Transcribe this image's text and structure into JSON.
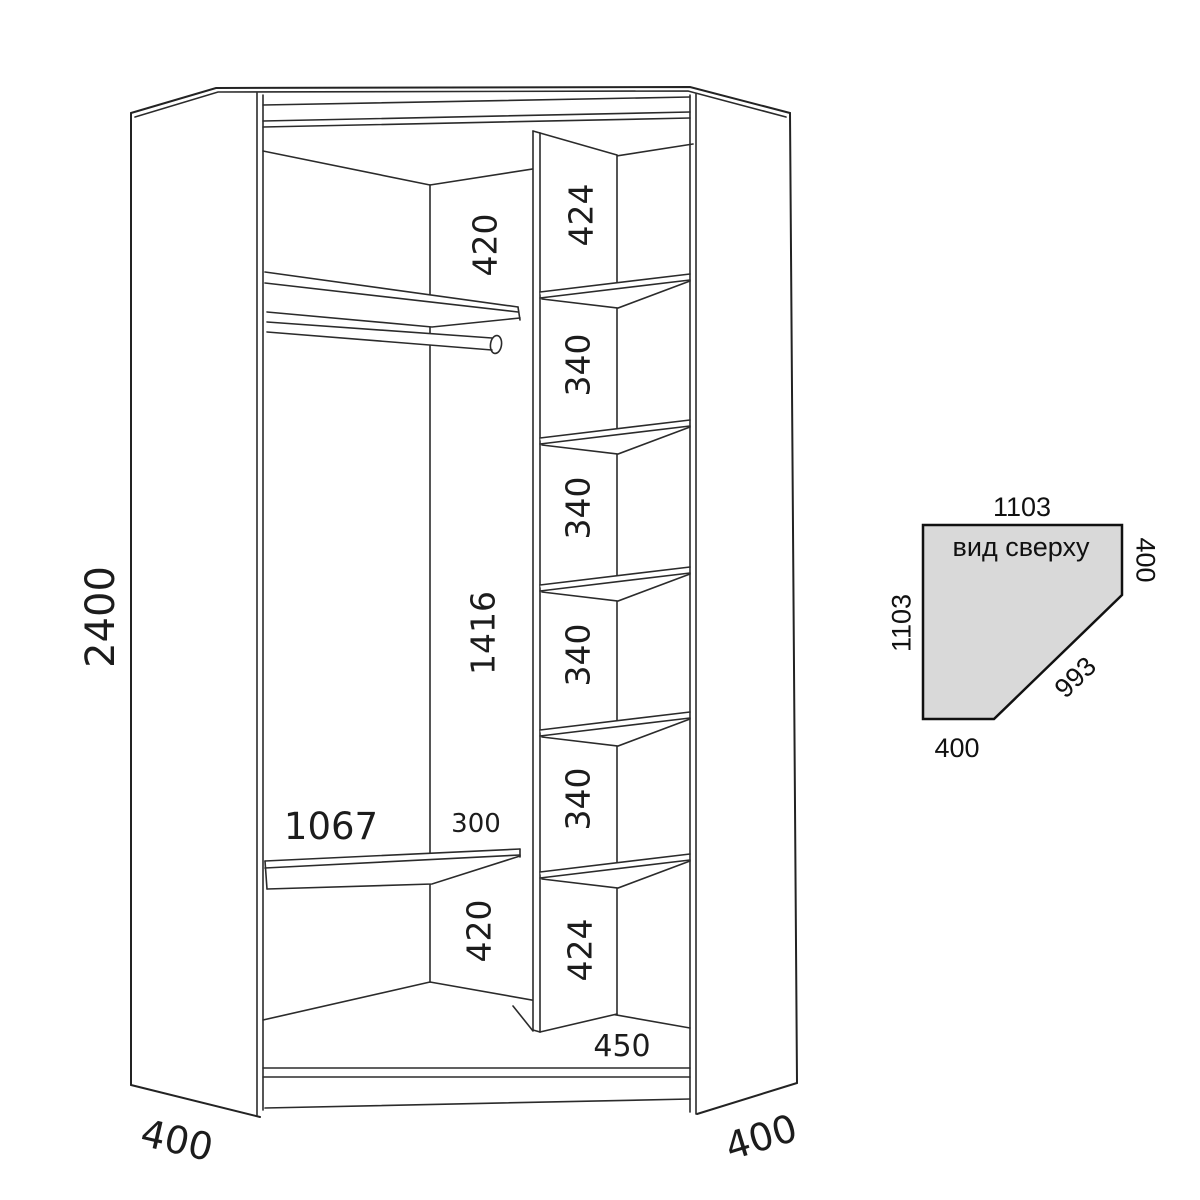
{
  "front_view": {
    "total_height": "2400",
    "left_column": {
      "top_space": "420",
      "hanging_space": "1416",
      "bottom_space": "420"
    },
    "shelf_board": {
      "width": "1067",
      "depth": "300"
    },
    "right_column": [
      "424",
      "340",
      "340",
      "340",
      "340",
      "424"
    ],
    "bottom_shelf_width": "450",
    "left_side_width": "400",
    "right_side_width": "400"
  },
  "top_view": {
    "title": "вид сверху",
    "top_width": "1103",
    "right_depth": "400",
    "left_depth": "1103",
    "front_diagonal": "993",
    "bottom_width": "400"
  },
  "colors": {
    "line": "#2b2b2b",
    "top_view_fill": "#d9d9d9"
  }
}
